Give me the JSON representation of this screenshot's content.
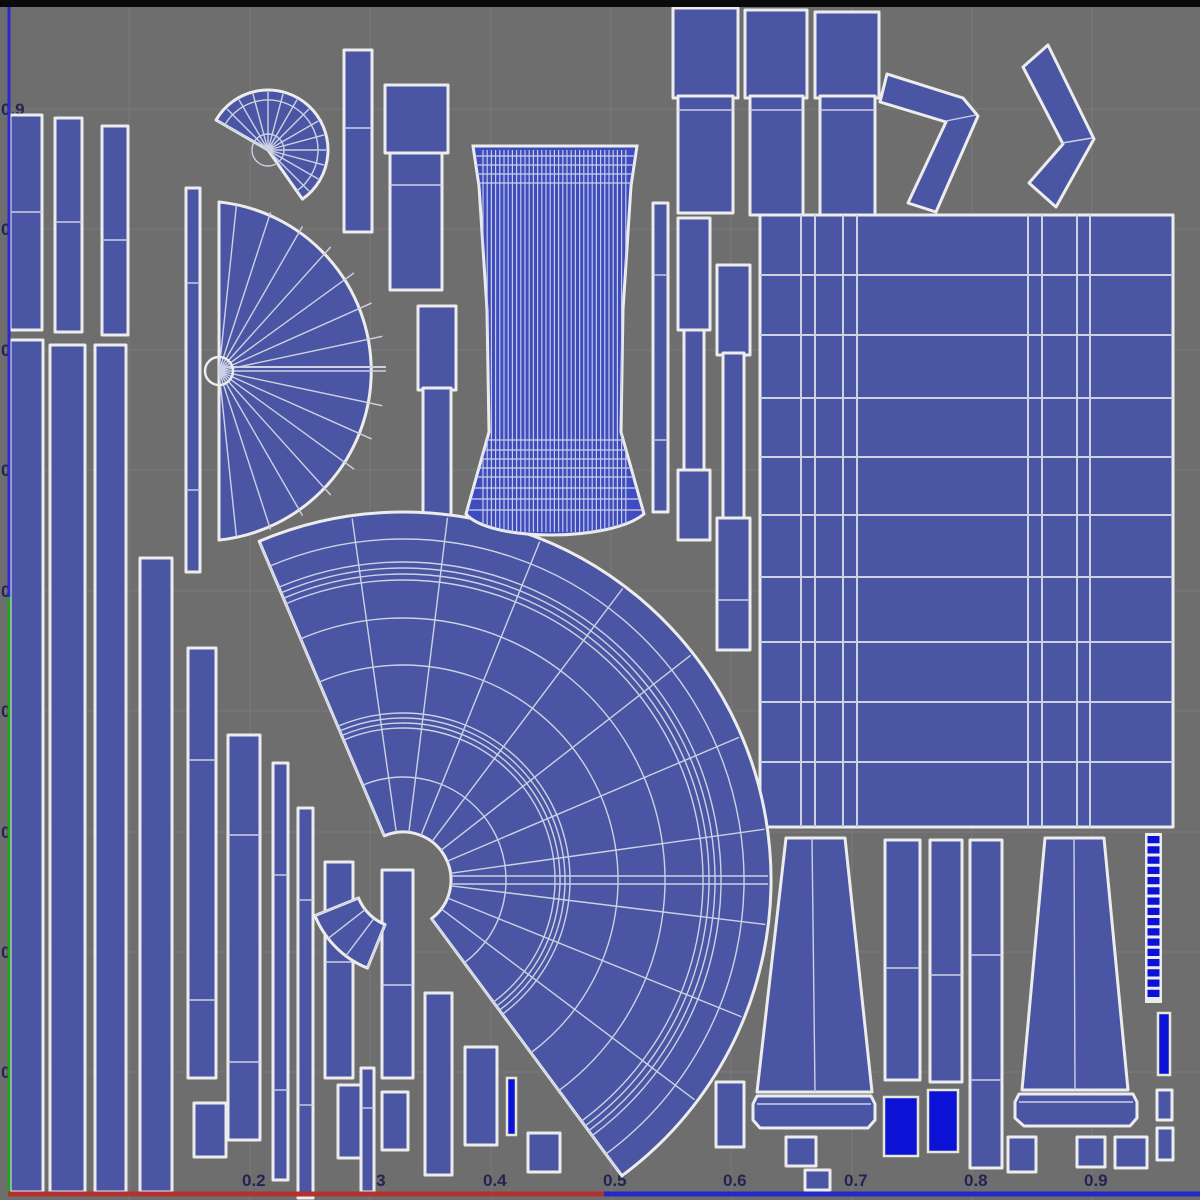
{
  "window": {
    "title": "uv-editor-viewport"
  },
  "colors": {
    "background": "#6e6e6e",
    "grid_line": "#7c7c7c",
    "island_fill": "#4a55a3",
    "island_outline": "#ececec",
    "wire": "#ccd2e4",
    "bright_fill": "#0b12d6",
    "bright_outline": "#e8e8d8",
    "label_text": "#1b1b52",
    "top_bar": "#0a0a0a",
    "v_axis_blue": "#2a2ad0",
    "v_axis_green": "#1fa21f",
    "u_axis_red": "#b23131",
    "u_axis_blue": "#2629c8",
    "cylinder_fill": "#3f4cc0"
  },
  "axis": {
    "left_labels": [
      {
        "text": "0.9",
        "y": 109
      },
      {
        "text": "0.8",
        "y": 229
      },
      {
        "text": "0.7",
        "y": 350
      },
      {
        "text": "0.6",
        "y": 470
      },
      {
        "text": "0.5",
        "y": 591
      },
      {
        "text": "0.4",
        "y": 711
      },
      {
        "text": "0.3",
        "y": 832
      },
      {
        "text": "0.2",
        "y": 952
      },
      {
        "text": "0.1",
        "y": 1072
      }
    ],
    "bottom_labels": [
      {
        "text": "0.2",
        "x": 256
      },
      {
        "text": "0.3",
        "x": 376
      },
      {
        "text": "0.4",
        "x": 497
      },
      {
        "text": "0.5",
        "x": 617
      },
      {
        "text": "0.6",
        "x": 737
      },
      {
        "text": "0.7",
        "x": 858
      },
      {
        "text": "0.8",
        "x": 978
      },
      {
        "text": "0.9",
        "x": 1098
      }
    ],
    "bottom_label_y": 1186,
    "grid_x": [
      129,
      250,
      370,
      491,
      611,
      731,
      852,
      972,
      1092
    ],
    "grid_y": [
      109,
      229,
      350,
      470,
      591,
      711,
      832,
      952,
      1072
    ],
    "top_bar_h": 7,
    "v_blue": {
      "x": 9,
      "y1": 7,
      "y2": 597
    },
    "v_green": {
      "x": 9,
      "y1": 597,
      "y2": 1193
    },
    "u_red": {
      "y": 1194,
      "x1": 8,
      "x2": 604
    },
    "u_blue": {
      "y": 1194,
      "x1": 604,
      "x2": 1200
    }
  },
  "islands": {
    "bars": [
      {
        "x": 10,
        "y": 115,
        "w": 32,
        "h": 215,
        "segs": [
          212
        ]
      },
      {
        "x": 55,
        "y": 118,
        "w": 27,
        "h": 214,
        "segs": [
          222
        ]
      },
      {
        "x": 102,
        "y": 126,
        "w": 26,
        "h": 209,
        "segs": [
          240
        ]
      },
      {
        "x": 10,
        "y": 340,
        "w": 33,
        "h": 852,
        "segs": []
      },
      {
        "x": 50,
        "y": 345,
        "w": 35,
        "h": 847,
        "segs": []
      },
      {
        "x": 95,
        "y": 345,
        "w": 31,
        "h": 847,
        "segs": []
      },
      {
        "x": 140,
        "y": 558,
        "w": 32,
        "h": 634,
        "segs": []
      },
      {
        "x": 186,
        "y": 188,
        "w": 14,
        "h": 384,
        "segs": [
          283,
          490
        ]
      },
      {
        "x": 188,
        "y": 648,
        "w": 28,
        "h": 430,
        "segs": [
          760,
          1000
        ]
      },
      {
        "x": 194,
        "y": 1103,
        "w": 32,
        "h": 54,
        "segs": []
      },
      {
        "x": 228,
        "y": 735,
        "w": 32,
        "h": 405,
        "segs": [
          835,
          1062
        ]
      },
      {
        "x": 273,
        "y": 763,
        "w": 15,
        "h": 417,
        "segs": [
          875,
          1090
        ]
      },
      {
        "x": 298,
        "y": 808,
        "w": 15,
        "h": 390,
        "segs": [
          900,
          1105
        ]
      },
      {
        "x": 325,
        "y": 862,
        "w": 28,
        "h": 216,
        "segs": [
          962
        ]
      },
      {
        "x": 338,
        "y": 1085,
        "w": 28,
        "h": 73,
        "segs": []
      },
      {
        "x": 361,
        "y": 1068,
        "w": 13,
        "h": 124,
        "segs": [
          1108
        ]
      },
      {
        "x": 382,
        "y": 870,
        "w": 31,
        "h": 208,
        "segs": [
          985
        ]
      },
      {
        "x": 382,
        "y": 1092,
        "w": 26,
        "h": 58,
        "segs": []
      },
      {
        "x": 425,
        "y": 993,
        "w": 27,
        "h": 182,
        "segs": []
      },
      {
        "x": 465,
        "y": 1047,
        "w": 32,
        "h": 98,
        "segs": []
      },
      {
        "x": 528,
        "y": 1133,
        "w": 32,
        "h": 39,
        "segs": []
      },
      {
        "x": 344,
        "y": 50,
        "w": 28,
        "h": 182,
        "segs": [
          128
        ]
      },
      {
        "x": 385,
        "y": 85,
        "w": 63,
        "h": 68,
        "segs": []
      },
      {
        "x": 390,
        "y": 153,
        "w": 52,
        "h": 137,
        "segs": [
          185
        ]
      },
      {
        "x": 418,
        "y": 306,
        "w": 38,
        "h": 84,
        "segs": []
      },
      {
        "x": 423,
        "y": 388,
        "w": 28,
        "h": 132,
        "segs": []
      },
      {
        "x": 653,
        "y": 203,
        "w": 15,
        "h": 309,
        "segs": [
          275,
          440
        ]
      },
      {
        "x": 678,
        "y": 218,
        "w": 32,
        "h": 112,
        "segs": []
      },
      {
        "x": 684,
        "y": 330,
        "w": 20,
        "h": 140,
        "segs": []
      },
      {
        "x": 678,
        "y": 470,
        "w": 32,
        "h": 70,
        "segs": []
      },
      {
        "x": 717,
        "y": 265,
        "w": 33,
        "h": 90,
        "segs": []
      },
      {
        "x": 723,
        "y": 353,
        "w": 21,
        "h": 167,
        "segs": []
      },
      {
        "x": 717,
        "y": 518,
        "w": 33,
        "h": 132,
        "segs": [
          600
        ]
      },
      {
        "x": 673,
        "y": 8,
        "w": 65,
        "h": 90,
        "segs": []
      },
      {
        "x": 678,
        "y": 96,
        "w": 55,
        "h": 117,
        "segs": [
          110
        ]
      },
      {
        "x": 745,
        "y": 10,
        "w": 62,
        "h": 88,
        "segs": []
      },
      {
        "x": 750,
        "y": 96,
        "w": 53,
        "h": 119,
        "segs": [
          110
        ]
      },
      {
        "x": 815,
        "y": 12,
        "w": 64,
        "h": 86,
        "segs": []
      },
      {
        "x": 820,
        "y": 96,
        "w": 55,
        "h": 119,
        "segs": [
          110
        ]
      },
      {
        "x": 885,
        "y": 840,
        "w": 35,
        "h": 240,
        "segs": [
          968
        ]
      },
      {
        "x": 930,
        "y": 840,
        "w": 32,
        "h": 242,
        "segs": [
          975
        ]
      },
      {
        "x": 970,
        "y": 840,
        "w": 32,
        "h": 328,
        "segs": [
          955,
          1080
        ]
      },
      {
        "x": 786,
        "y": 1137,
        "w": 30,
        "h": 29,
        "segs": []
      },
      {
        "x": 1008,
        "y": 1137,
        "w": 28,
        "h": 35,
        "segs": []
      },
      {
        "x": 1077,
        "y": 1137,
        "w": 28,
        "h": 30,
        "segs": []
      },
      {
        "x": 1115,
        "y": 1137,
        "w": 32,
        "h": 31,
        "segs": []
      },
      {
        "x": 1157,
        "y": 1090,
        "w": 15,
        "h": 30,
        "segs": []
      },
      {
        "x": 1157,
        "y": 1128,
        "w": 16,
        "h": 32,
        "segs": []
      },
      {
        "x": 805,
        "y": 1170,
        "w": 25,
        "h": 20,
        "segs": []
      },
      {
        "x": 716,
        "y": 1082,
        "w": 28,
        "h": 65,
        "segs": []
      }
    ],
    "bright_bars": [
      {
        "x": 507,
        "y": 1078,
        "w": 9,
        "h": 57
      },
      {
        "x": 884,
        "y": 1097,
        "w": 34,
        "h": 59
      },
      {
        "x": 928,
        "y": 1090,
        "w": 30,
        "h": 62
      },
      {
        "x": 1158,
        "y": 1013,
        "w": 12,
        "h": 62
      }
    ],
    "polys": [
      {
        "pts": "786,838 845,838 872,1092 757,1092"
      },
      {
        "pts": "757,1096 871,1096 875,1104 875,1120 868,1128 760,1128 753,1120 753,1104"
      },
      {
        "pts": "1045,838 1104,838 1128,1090 1022,1090"
      },
      {
        "pts": "1019,1094 1133,1094 1137,1102 1137,1118 1130,1126 1024,1126 1015,1118 1015,1102"
      }
    ],
    "paths": [
      {
        "d": "M887,74 L963,98 L978,116 L936,212 L908,203 L946,122 L880,102 Z"
      },
      {
        "d": "M1023,67 L1048,45 L1094,139 L1056,207 L1029,183 L1063,144 Z"
      }
    ],
    "wire_lines": [
      [
        812,
        838,
        815,
        1092
      ],
      [
        1074,
        838,
        1075,
        1090
      ],
      [
        946,
        121,
        976,
        115
      ],
      [
        1062,
        143,
        1092,
        138
      ],
      [
        757,
        1104,
        871,
        1104
      ],
      [
        1019,
        1102,
        1133,
        1102
      ]
    ],
    "gridrect": {
      "x": 760,
      "y": 215,
      "w": 413,
      "h": 612,
      "vx": [
        801,
        815,
        843,
        857,
        1028,
        1042,
        1077,
        1090
      ],
      "hy": [
        275,
        335,
        398,
        457,
        515,
        577,
        642,
        702,
        762
      ]
    },
    "halfdisc": {
      "cx": 219,
      "cy": 371,
      "r": 170,
      "a0": -84,
      "a1": 84,
      "spoke_step": 12,
      "hub": 14
    },
    "smallfan": {
      "cx": 268,
      "cy": 150,
      "r": 60,
      "a0": -150,
      "a1": 55,
      "spoke_step": 15,
      "hub": 16,
      "mid_arc": 50
    },
    "bigfan": {
      "cx": 403,
      "cy": 880,
      "r0": 48,
      "r1": 368,
      "a0": -113,
      "a1": 53.5,
      "spokes": [
        -113,
        -98,
        -83,
        -68,
        -53,
        -38,
        -23,
        -8,
        7,
        22,
        37,
        53.5
      ],
      "arcs": [
        103,
        152,
        157,
        162,
        167,
        215,
        262,
        300,
        306,
        312,
        318,
        341
      ],
      "equator_y": [
        876,
        884
      ],
      "sub": {
        "r0": 48,
        "r1": 95,
        "a0": 112,
        "a1": 158,
        "spokes": [
          112,
          127,
          142,
          158
        ]
      }
    },
    "cylinder": {
      "outline": "M473,146 L637,146 L631,186 L623,310 L621,432 L644,514 C610,542 490,542 466,514 L489,432 L487,310 L479,186 Z",
      "stripe_x0": 483,
      "stripe_step": 4.2,
      "stripe_count": 35,
      "stripe_y0": 150,
      "stripe_y1": 532,
      "hlines_y": [
        156,
        165,
        174,
        183,
        440,
        450,
        459,
        468,
        477,
        488,
        499,
        510
      ]
    },
    "ladder": {
      "x": 1145,
      "y": 833,
      "w": 17,
      "h": 170,
      "cells": 16
    }
  }
}
